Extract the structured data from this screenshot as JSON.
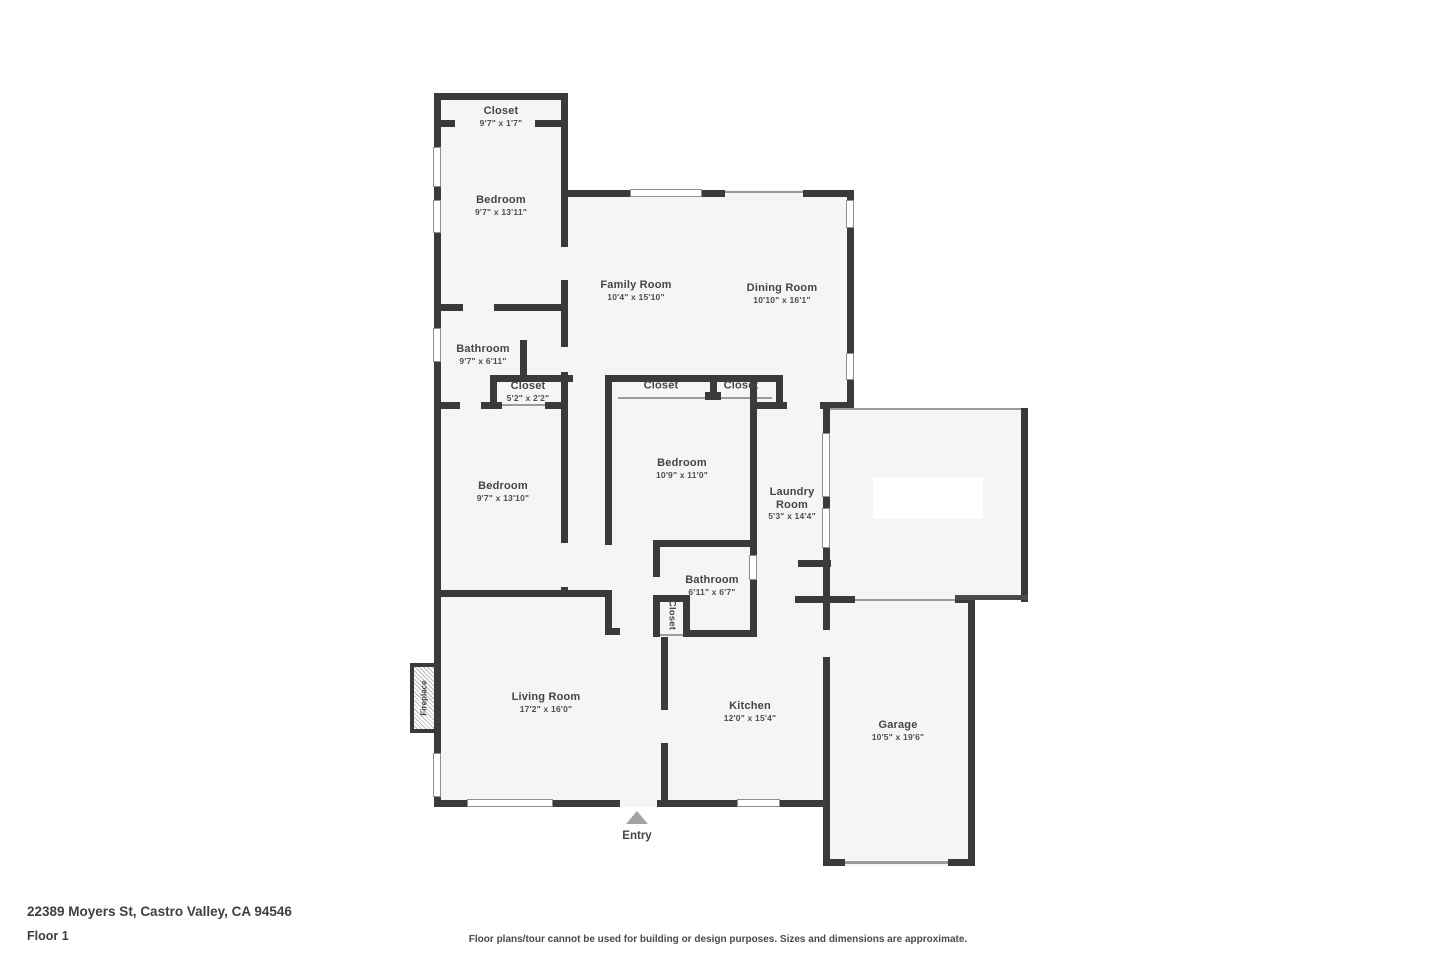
{
  "meta": {
    "address": "22389 Moyers St, Castro Valley, CA 94546",
    "floor_label": "Floor 1",
    "disclaimer": "Floor plans/tour cannot be used for building or design purposes. Sizes and dimensions are approximate."
  },
  "rooms": {
    "closet_top": {
      "name": "Closet",
      "dims": "9'7\" x 1'7\""
    },
    "bedroom_top": {
      "name": "Bedroom",
      "dims": "9'7\" x 13'11\""
    },
    "family_room": {
      "name": "Family Room",
      "dims": "10'4\" x 15'10\""
    },
    "dining_room": {
      "name": "Dining Room",
      "dims": "10'10\" x 16'1\""
    },
    "bathroom_top": {
      "name": "Bathroom",
      "dims": "9'7\" x 6'11\""
    },
    "closet_hall": {
      "name": "Closet",
      "dims": "5'2\" x 2'2\""
    },
    "closet_mid_left": {
      "name": "Closet"
    },
    "closet_mid_right": {
      "name": "Closet"
    },
    "bedroom_left": {
      "name": "Bedroom",
      "dims": "9'7\" x 13'10\""
    },
    "bedroom_mid": {
      "name": "Bedroom",
      "dims": "10'9\" x 11'0\""
    },
    "laundry_room": {
      "name": "Laundry Room",
      "dims": "5'3\" x 14'4\""
    },
    "bathroom_mid": {
      "name": "Bathroom",
      "dims": "6'11\" x 6'7\""
    },
    "closet_small": {
      "name": "Closet"
    },
    "living_room": {
      "name": "Living Room",
      "dims": "17'2\" x 16'0\""
    },
    "kitchen": {
      "name": "Kitchen",
      "dims": "12'0\" x 15'4\""
    },
    "garage": {
      "name": "Garage",
      "dims": "10'5\" x 19'6\""
    }
  },
  "markers": {
    "entry_label": "Entry",
    "fireplace_label": "Fireplace"
  },
  "colors": {
    "wall": "#3a3a3c",
    "floor_fill": "#f5f5f4",
    "label_text": "#454545",
    "entry_arrow": "#a3a3a3"
  }
}
